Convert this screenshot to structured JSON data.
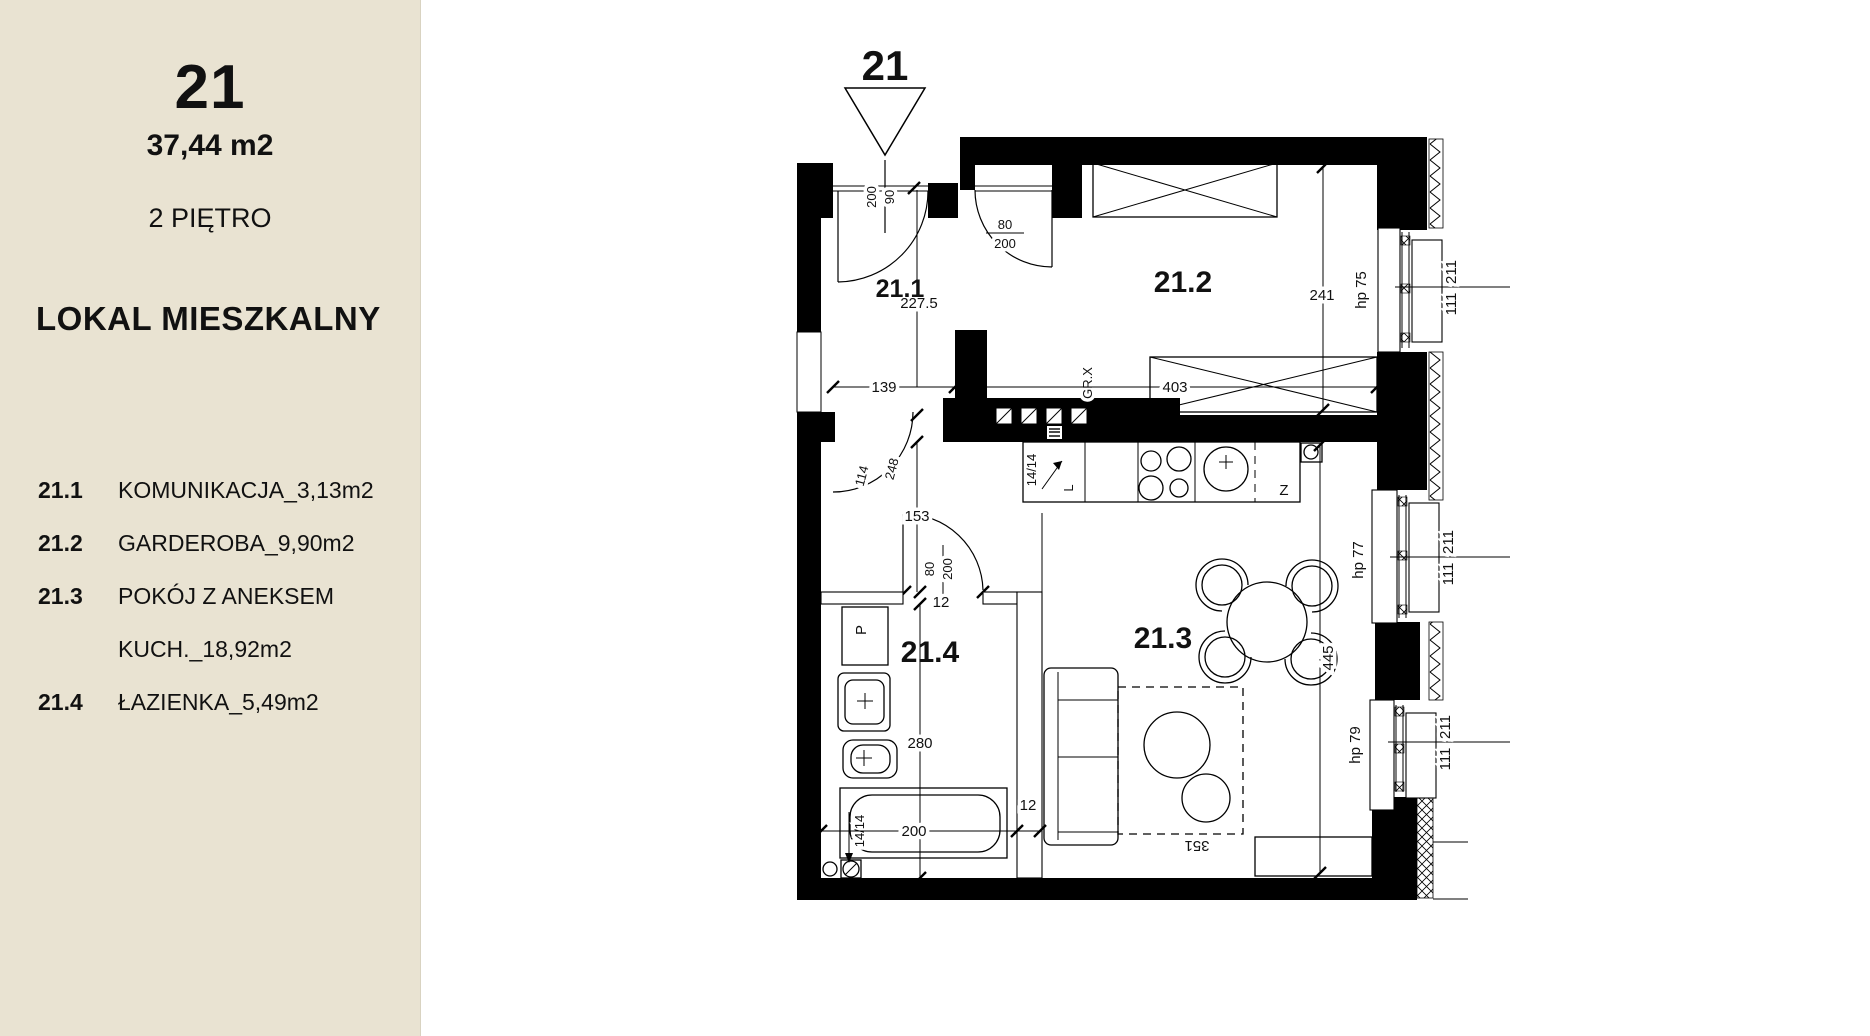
{
  "sidebar": {
    "unit_number": "21",
    "area": "37,44 m2",
    "floor": "2 PIĘTRO",
    "category": "LOKAL MIESZKALNY",
    "rooms": [
      {
        "no": "21.1",
        "line1": "KOMUNIKACJA_3,13m2",
        "line2": ""
      },
      {
        "no": "21.2",
        "line1": "GARDEROBA_9,90m2",
        "line2": ""
      },
      {
        "no": "21.3",
        "line1": "POKÓJ Z ANEKSEM",
        "line2": "KUCH._18,92m2"
      },
      {
        "no": "21.4",
        "line1": "ŁAZIENKA_5,49m2",
        "line2": ""
      }
    ]
  },
  "plan": {
    "entrance_marker": "21",
    "room_labels": {
      "hall": "21.1",
      "wardrobe": "21.2",
      "living": "21.3",
      "bath": "21.4"
    },
    "dims": {
      "entry_door_w": "90",
      "entry_door_h": "200",
      "hall_w": "139",
      "hall_l": "227.5",
      "door2_w": "80",
      "door2_h": "200",
      "wardrobe_w": "403",
      "wardrobe_d": "241",
      "niche_a": "114",
      "niche_b": "248",
      "corridor_l": "153",
      "bathdoor_w": "80",
      "bathdoor_h": "200",
      "partition_t": "12",
      "bath_l": "280",
      "tub_l": "200",
      "tub_gap": "12",
      "living_l": "445",
      "living_w": "351"
    },
    "windows": [
      {
        "label": "hp 75",
        "dim_top": "211",
        "dim_bottom": "111"
      },
      {
        "label": "hp 77",
        "dim_top": "211",
        "dim_bottom": "111"
      },
      {
        "label": "hp 79",
        "dim_top": "211",
        "dim_bottom": "111"
      }
    ],
    "annotations": {
      "wardrobe_unit": "GR.X",
      "vent_kitchen": "14/14",
      "kitchen_corner": "L",
      "fridge": "Z",
      "vent_bath": "14/14",
      "washer": "P"
    }
  },
  "colors": {
    "sidebar_bg": "#e9e3d2",
    "line": "#000000",
    "bg": "#ffffff"
  }
}
